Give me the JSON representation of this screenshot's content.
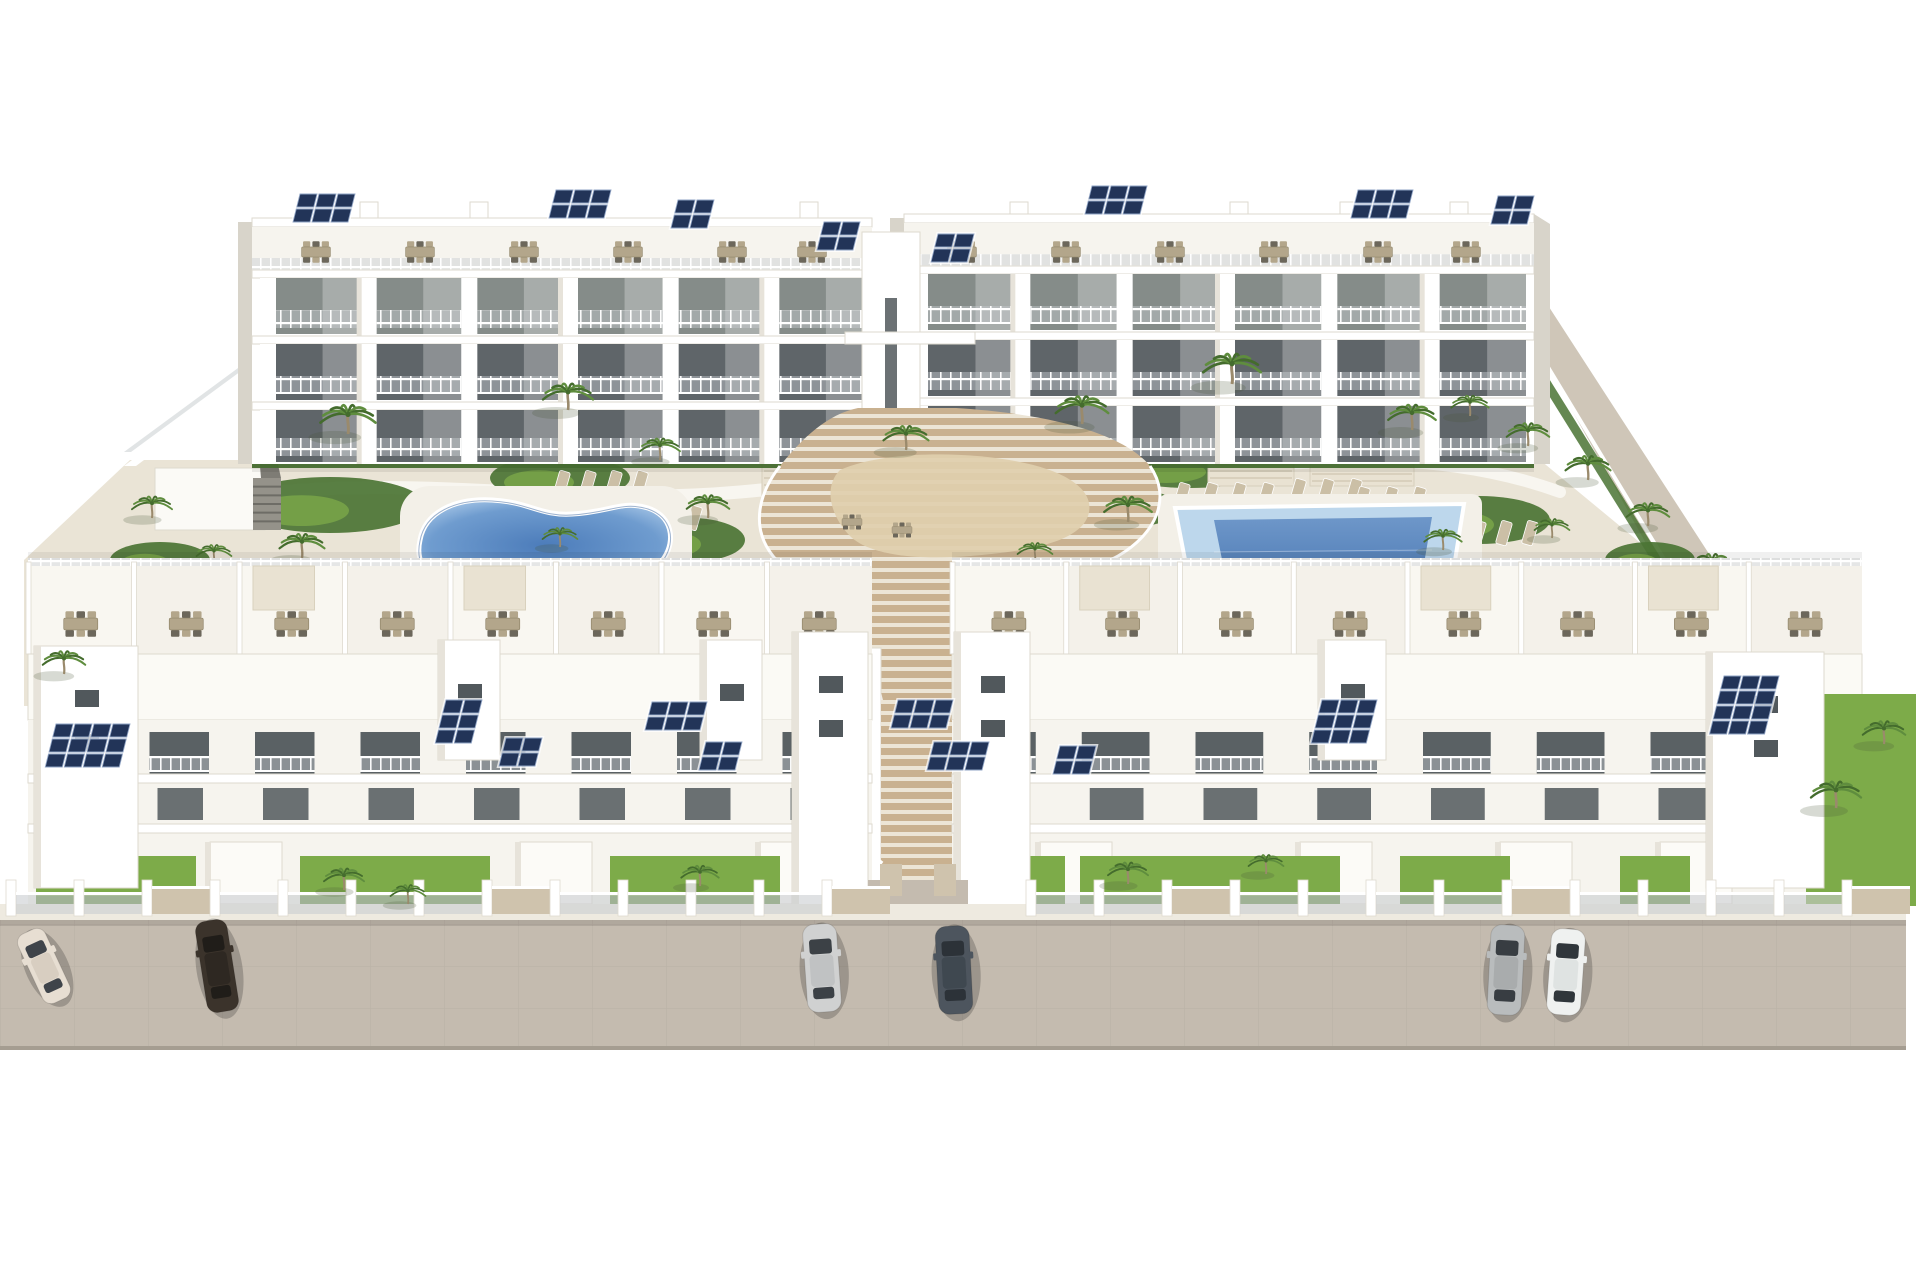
{
  "scene": {
    "description": "aerial-3d-render-of-white-apartment-complex-with-two-pools-central-wood-stairs-and-street-parking",
    "background": "#ffffff",
    "colors": {
      "wall_white": "#ffffff",
      "wall_warm": "#f6f4ee",
      "wall_shade": "#e7e3da",
      "wall_side": "#d8d4ca",
      "slab_line": "#dedacf",
      "window_dark": "#51585c",
      "window_mid": "#7b827f",
      "glass_rail": "#c9cdd0",
      "hedge": "#4b7434",
      "grass": "#7dab49",
      "palm_green": "#5f8d3e",
      "palm_dark": "#446c2d",
      "palm_trunk": "#9a8a6c",
      "courtyard": "#eae4d6",
      "path": "#f8f6f0",
      "walkway": "#cfc6b8",
      "wood_light": "#c9b190",
      "wood_riser": "#ece5d6",
      "deck_flat": "#dfcfae",
      "pool_core": "#4e7db9",
      "pool_mid": "#7fa9d6",
      "pool_edge": "#bdd7ec",
      "street": "#c4bbaf",
      "street_seam": "#b0a79b",
      "sidewalk": "#eeeae0",
      "solar": "#223458",
      "solar_frame": "#8fa3c4",
      "furn_tan": "#b3a68b",
      "furn_dark": "#6c675b",
      "canopy": "#e9e2d2",
      "gray_struct": "#95928a"
    },
    "back_row": {
      "wings": [
        {
          "x": 252,
          "y": 218,
          "w": 620,
          "h": 246,
          "modules": 6
        },
        {
          "x": 904,
          "y": 214,
          "w": 630,
          "h": 250,
          "modules": 6
        }
      ],
      "tower": {
        "x": 862,
        "y": 232,
        "w": 58,
        "h": 236
      },
      "bridge": {
        "x": 845,
        "y": 332,
        "w": 130,
        "h": 12
      },
      "solar": [
        {
          "x": 300,
          "y": 194,
          "c": 3,
          "r": 2
        },
        {
          "x": 556,
          "y": 190,
          "c": 3,
          "r": 2
        },
        {
          "x": 678,
          "y": 200,
          "c": 2,
          "r": 2
        },
        {
          "x": 824,
          "y": 222,
          "c": 2,
          "r": 2
        },
        {
          "x": 938,
          "y": 234,
          "c": 2,
          "r": 2
        },
        {
          "x": 1092,
          "y": 186,
          "c": 3,
          "r": 2
        },
        {
          "x": 1358,
          "y": 190,
          "c": 3,
          "r": 2
        },
        {
          "x": 1498,
          "y": 196,
          "c": 2,
          "r": 2
        }
      ],
      "dining_y": 252,
      "dining_xs": [
        316,
        420,
        524,
        628,
        732,
        812,
        962,
        1066,
        1170,
        1274,
        1378,
        1466
      ],
      "roof_boxes": [
        360,
        470,
        580,
        690,
        800,
        1010,
        1120,
        1230,
        1340,
        1450
      ]
    },
    "front_row": {
      "terrace_y": 558,
      "terrace_h": 96,
      "roof_y": 654,
      "roof_h": 66,
      "facade_y": 720,
      "facade_h": 186,
      "wings": [
        {
          "x": 28,
          "w": 844,
          "units": 8
        },
        {
          "x": 952,
          "w": 910,
          "units": 8
        }
      ],
      "gap": {
        "x1": 868,
        "x2": 968
      },
      "pergola_units": [
        2,
        4,
        9,
        12,
        14
      ],
      "towers": [
        {
          "x": 34,
          "w": 104,
          "y": 646,
          "h": 242,
          "win": 2
        },
        {
          "x": 438,
          "w": 62,
          "y": 640,
          "h": 120,
          "win": 1
        },
        {
          "x": 700,
          "w": 62,
          "y": 640,
          "h": 120,
          "win": 1
        },
        {
          "x": 792,
          "w": 76,
          "y": 632,
          "h": 274,
          "win": 2
        },
        {
          "x": 954,
          "w": 76,
          "y": 632,
          "h": 274,
          "win": 2
        },
        {
          "x": 1318,
          "w": 68,
          "y": 640,
          "h": 120,
          "win": 1
        },
        {
          "x": 1706,
          "w": 118,
          "y": 652,
          "h": 236,
          "win": 2
        }
      ],
      "solar": [
        {
          "x": 56,
          "y": 724,
          "c": 4,
          "r": 3
        },
        {
          "x": 446,
          "y": 700,
          "c": 2,
          "r": 3
        },
        {
          "x": 506,
          "y": 738,
          "c": 2,
          "r": 2
        },
        {
          "x": 652,
          "y": 702,
          "c": 3,
          "r": 2
        },
        {
          "x": 706,
          "y": 742,
          "c": 2,
          "r": 2
        },
        {
          "x": 898,
          "y": 700,
          "c": 3,
          "r": 2
        },
        {
          "x": 934,
          "y": 742,
          "c": 3,
          "r": 2
        },
        {
          "x": 1060,
          "y": 746,
          "c": 2,
          "r": 2
        },
        {
          "x": 1322,
          "y": 700,
          "c": 3,
          "r": 3
        },
        {
          "x": 1724,
          "y": 676,
          "c": 3,
          "r": 4
        }
      ],
      "ground_boxes": [
        210,
        520,
        760,
        1040,
        1300,
        1500,
        1660
      ],
      "gardens": [
        {
          "x": 36,
          "w": 160
        },
        {
          "x": 300,
          "w": 190
        },
        {
          "x": 610,
          "w": 170
        },
        {
          "x": 1005,
          "w": 60
        },
        {
          "x": 1080,
          "w": 130
        },
        {
          "x": 1210,
          "w": 130
        },
        {
          "x": 1400,
          "w": 110
        },
        {
          "x": 1620,
          "w": 70
        }
      ],
      "corner_garden": {
        "x": 1806,
        "y": 694,
        "w": 110,
        "h": 212
      }
    },
    "street": {
      "y": 920,
      "h": 126,
      "sidewalk_y": 904,
      "fence_step": 68,
      "fence_y": 880
    },
    "cars": [
      {
        "name": "cream-sedan",
        "body": "#e7ded2",
        "roof": "#d8cec1",
        "glass": "#3f444a",
        "x": 44,
        "y": 966,
        "angle": -25,
        "len": 76,
        "wid": 30
      },
      {
        "name": "dark-brown-sedan",
        "body": "#3b332b",
        "roof": "#2e2822",
        "glass": "#201d19",
        "x": 217,
        "y": 966,
        "angle": -9,
        "len": 92,
        "wid": 32
      },
      {
        "name": "silver-car",
        "body": "#d0d1d1",
        "roof": "#c0c2c3",
        "glass": "#3c4146",
        "x": 822,
        "y": 968,
        "angle": -4,
        "len": 88,
        "wid": 34
      },
      {
        "name": "graphite-car",
        "body": "#4d555e",
        "roof": "#3f4850",
        "glass": "#2c3238",
        "x": 954,
        "y": 970,
        "angle": -3,
        "len": 88,
        "wid": 34
      },
      {
        "name": "silver-suv",
        "body": "#b9bcbd",
        "roof": "#a9acad",
        "glass": "#383d42",
        "x": 1506,
        "y": 970,
        "angle": 3,
        "len": 90,
        "wid": 34
      },
      {
        "name": "white-car",
        "body": "#eff1f0",
        "roof": "#dfe3e2",
        "glass": "#30363b",
        "x": 1566,
        "y": 972,
        "angle": 4,
        "len": 86,
        "wid": 34
      }
    ],
    "palms_back": [
      {
        "x": 348,
        "y": 432,
        "s": 1.1
      },
      {
        "x": 568,
        "y": 408,
        "s": 1.0
      },
      {
        "x": 660,
        "y": 458,
        "s": 0.8
      },
      {
        "x": 906,
        "y": 448,
        "s": 0.9
      },
      {
        "x": 1082,
        "y": 422,
        "s": 1.05
      },
      {
        "x": 1232,
        "y": 382,
        "s": 1.15
      },
      {
        "x": 1412,
        "y": 428,
        "s": 0.95
      },
      {
        "x": 1470,
        "y": 414,
        "s": 0.75
      },
      {
        "x": 302,
        "y": 556,
        "s": 0.9
      },
      {
        "x": 252,
        "y": 606,
        "s": 0.75
      },
      {
        "x": 708,
        "y": 516,
        "s": 0.85
      },
      {
        "x": 560,
        "y": 545,
        "s": 0.7
      },
      {
        "x": 1128,
        "y": 520,
        "s": 0.95
      },
      {
        "x": 1308,
        "y": 588,
        "s": 0.9
      },
      {
        "x": 1443,
        "y": 548,
        "s": 0.75
      },
      {
        "x": 1035,
        "y": 560,
        "s": 0.7
      },
      {
        "x": 1528,
        "y": 444,
        "s": 0.85
      },
      {
        "x": 1588,
        "y": 478,
        "s": 0.9
      },
      {
        "x": 1648,
        "y": 524,
        "s": 0.85
      },
      {
        "x": 1552,
        "y": 536,
        "s": 0.7
      },
      {
        "x": 1712,
        "y": 576,
        "s": 0.9
      },
      {
        "x": 152,
        "y": 516,
        "s": 0.8
      },
      {
        "x": 214,
        "y": 562,
        "s": 0.7
      }
    ],
    "palms_front": [
      {
        "x": 64,
        "y": 672,
        "s": 0.85
      },
      {
        "x": 344,
        "y": 888,
        "s": 0.8
      },
      {
        "x": 408,
        "y": 902,
        "s": 0.7
      },
      {
        "x": 700,
        "y": 884,
        "s": 0.75
      },
      {
        "x": 1128,
        "y": 882,
        "s": 0.8
      },
      {
        "x": 1266,
        "y": 872,
        "s": 0.7
      },
      {
        "x": 1836,
        "y": 806,
        "s": 1.0
      },
      {
        "x": 1884,
        "y": 742,
        "s": 0.85
      }
    ],
    "garden_blobs": [
      {
        "x": 330,
        "y": 505,
        "rx": 95,
        "ry": 28
      },
      {
        "x": 560,
        "y": 478,
        "rx": 70,
        "ry": 22
      },
      {
        "x": 690,
        "y": 540,
        "rx": 55,
        "ry": 22
      },
      {
        "x": 255,
        "y": 612,
        "rx": 70,
        "ry": 26
      },
      {
        "x": 160,
        "y": 560,
        "rx": 50,
        "ry": 18
      },
      {
        "x": 1010,
        "y": 478,
        "rx": 85,
        "ry": 26
      },
      {
        "x": 952,
        "y": 556,
        "rx": 48,
        "ry": 20
      },
      {
        "x": 1120,
        "y": 508,
        "rx": 60,
        "ry": 20
      },
      {
        "x": 1190,
        "y": 468,
        "rx": 80,
        "ry": 20
      },
      {
        "x": 1480,
        "y": 520,
        "rx": 70,
        "ry": 24
      },
      {
        "x": 1560,
        "y": 600,
        "rx": 60,
        "ry": 22
      },
      {
        "x": 1650,
        "y": 560,
        "rx": 45,
        "ry": 18
      },
      {
        "x": 870,
        "y": 432,
        "rx": 60,
        "ry": 16
      },
      {
        "x": 760,
        "y": 442,
        "rx": 40,
        "ry": 14
      }
    ],
    "loungers": [
      {
        "x": 560,
        "y": 470,
        "n": 4,
        "dx": 26
      },
      {
        "x": 640,
        "y": 505,
        "n": 3,
        "dx": 26
      },
      {
        "x": 1180,
        "y": 482,
        "n": 4,
        "dx": 28
      },
      {
        "x": 1296,
        "y": 478,
        "n": 3,
        "dx": 28
      },
      {
        "x": 1360,
        "y": 486,
        "n": 3,
        "dx": 28
      },
      {
        "x": 1476,
        "y": 520,
        "n": 3,
        "dx": 26
      }
    ],
    "pergolas": [
      {
        "x": 762,
        "y": 452,
        "w": 128,
        "h": 54
      },
      {
        "x": 1208,
        "y": 452,
        "w": 86,
        "h": 34
      },
      {
        "x": 1310,
        "y": 448,
        "w": 104,
        "h": 38
      }
    ],
    "pool_left": {
      "deck": {
        "x": 400,
        "y": 486,
        "w": 292,
        "h": 116
      }
    },
    "pool_right": {
      "deck": {
        "x": 1158,
        "y": 494,
        "w": 324,
        "h": 112
      },
      "outer": "1175,508 1464,504 1450,592 1192,596",
      "inner": "1214,520 1432,517 1420,587 1228,589"
    },
    "gray_stair": {
      "x": 253,
      "y": 478,
      "w": 28,
      "h": 52
    },
    "carport": {
      "x": 155,
      "y": 468,
      "w": 110,
      "h": 62
    }
  }
}
